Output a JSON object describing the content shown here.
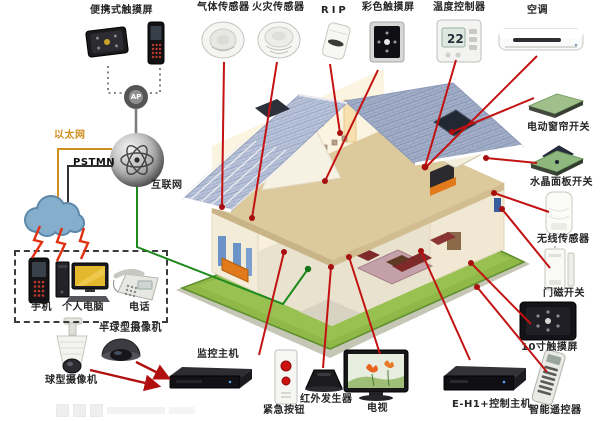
{
  "labels": {
    "portable_touchscreen": "便携式触摸屏",
    "gas_sensor": "气体传感器",
    "fire_sensor": "火灾传感器",
    "pir": "RIP",
    "color_touchscreen": "彩色触摸屏",
    "temperature_controller": "温度控制器",
    "air_conditioner": "空调",
    "electric_curtain_switch": "电动窗帘开关",
    "crystal_panel_switch": "水晶面板开关",
    "wireless_sensor": "无线传感器",
    "door_magnet_switch": "门磁开关",
    "touchscreen_10inch": "10寸触摸屏",
    "smart_remote": "智能遥控器",
    "eh1_control_host": "E-H1+控制主机",
    "tv": "电视",
    "ir_generator": "红外发生器",
    "emergency_button": "紧急按钮",
    "monitor_host": "监控主机",
    "dome_camera": "半球型摄像机",
    "ptz_camera": "球型摄像机",
    "mobile_phone": "手机",
    "pc": "个人电脑",
    "telephone": "电话",
    "ethernet": "以太网",
    "pstmn": "PSTMN",
    "internet": "互联网",
    "ap": "AP"
  },
  "thermostat": {
    "reading": "22"
  },
  "colors": {
    "line_red": "#c21212",
    "line_green": "#1e8a1e",
    "ethernet_orange": "#cf8f1e",
    "roof_blue": "#b9c3d9",
    "lawn_green": "#86b23e",
    "cloud_blue": "#85aecd"
  }
}
